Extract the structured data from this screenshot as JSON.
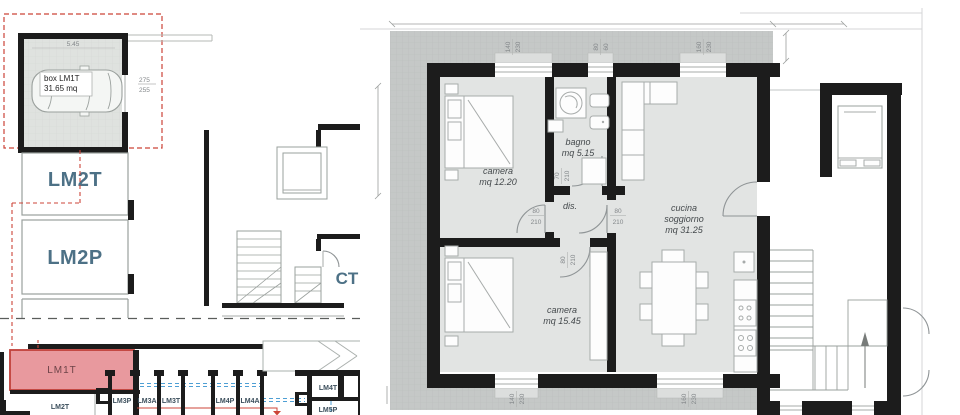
{
  "drawing": {
    "garage": {
      "label_line1": "box LM1T",
      "label_line2": "31.65 mq",
      "dim_width": "5.45",
      "dim_door_top": "275",
      "dim_door_bottom": "255"
    },
    "left_units": {
      "lm2t": "LM2T",
      "lm2p": "LM2P",
      "ct": "CT"
    },
    "key_plan": {
      "lm1t": "LM1T",
      "lm2t": "LM2T",
      "lm3p": "LM3P",
      "lm3a": "LM3A",
      "lm3t": "LM3T",
      "lm4p": "LM4P",
      "lm4a": "LM4A",
      "lm4t": "LM4T",
      "lm5p": "LM5P"
    },
    "apartment": {
      "rooms": {
        "camera1": {
          "name": "camera",
          "area": "mq 12.20"
        },
        "bagno": {
          "name": "bagno",
          "area": "mq 5.15"
        },
        "dis": {
          "name": "dis."
        },
        "camera2": {
          "name": "camera",
          "area": "mq 15.45"
        },
        "cucina": {
          "name1": "cucina",
          "name2": "soggiorno",
          "area": "mq 31.25"
        }
      },
      "openings": {
        "win_top_camera": {
          "w": "140",
          "h": "230"
        },
        "win_top_bagno": {
          "w": "80",
          "h": "60"
        },
        "win_top_cucina": {
          "w": "160",
          "h": "230"
        },
        "win_bottom_camera": {
          "w": "140",
          "h": "230"
        },
        "win_bottom_cucina": {
          "w": "160",
          "h": "230"
        },
        "door_dis_camera1": {
          "w": "80",
          "h": "210"
        },
        "door_dis_cucina": {
          "w": "80",
          "h": "210"
        },
        "door_dis_camera2": {
          "w": "80",
          "h": "210"
        },
        "door_bagno": {
          "w": "70",
          "h": "210"
        }
      }
    },
    "colors": {
      "accent_red": "#cc4438",
      "unit_blue": "#4d7186",
      "wall": "#1c1c1c",
      "terrace": "#c5c8c7",
      "floor": "#e2e4e3",
      "keyplan_highlight": "#e8999e",
      "section_blue": "#4e9fd4"
    }
  }
}
